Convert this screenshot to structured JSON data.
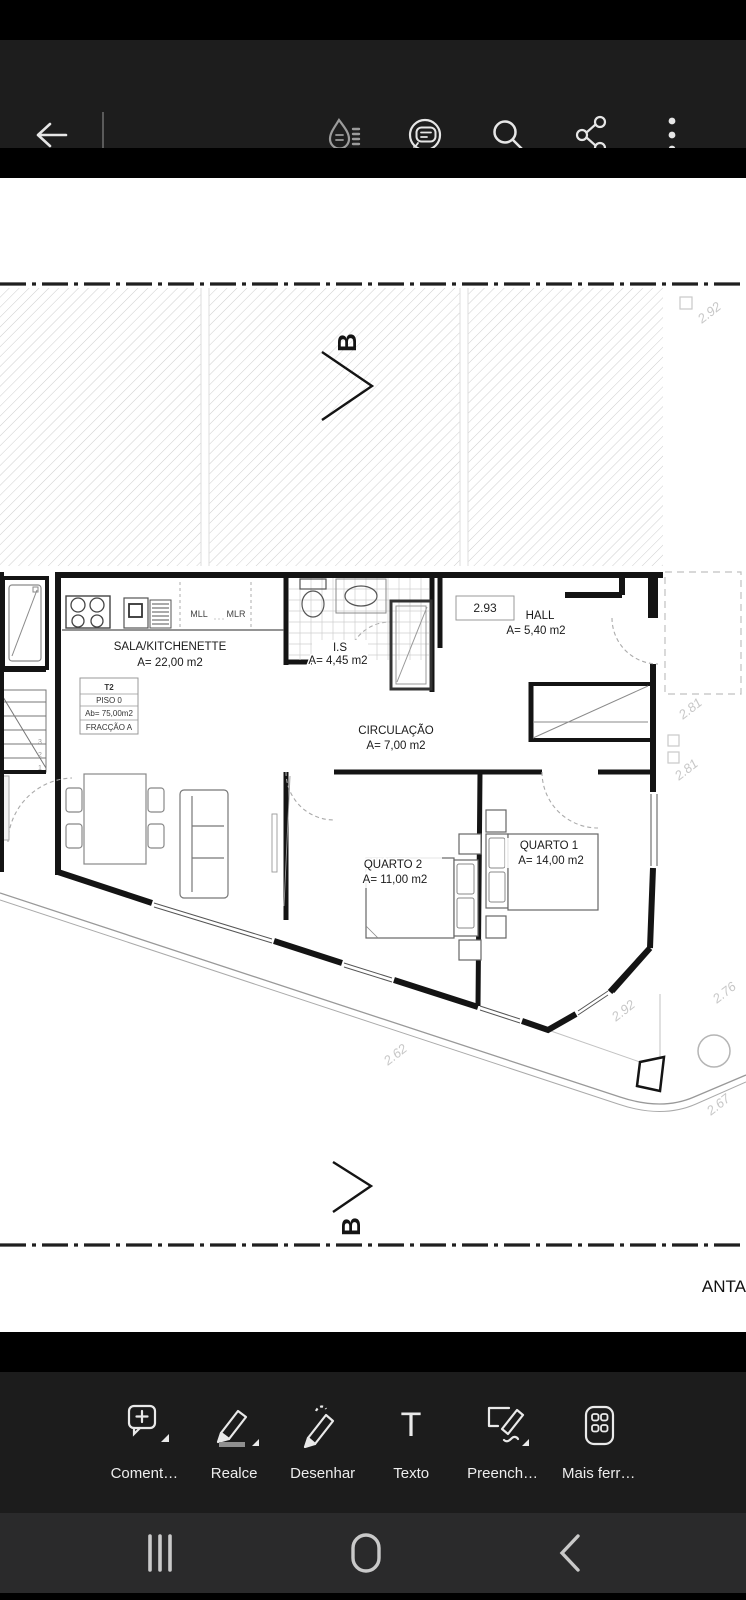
{
  "plan": {
    "rooms": [
      {
        "name": "SALA/KITCHENETTE",
        "area": "A= 22,00 m2"
      },
      {
        "name": "I.S",
        "area": "A= 4,45 m2"
      },
      {
        "name": "HALL",
        "area": "A= 5,40 m2"
      },
      {
        "name": "CIRCULAÇÃO",
        "area": "A= 7,00 m2"
      },
      {
        "name": "QUARTO 1",
        "area": "A= 14,00 m2"
      },
      {
        "name": "QUARTO 2",
        "area": "A= 11,00 m2"
      }
    ],
    "unit_box": {
      "type": "T2",
      "floor": "PISO 0",
      "area": "Ab= 75,00m2",
      "fraction": "FRACÇÃO A"
    },
    "counter": {
      "left": "MLL",
      "right": "MLR"
    },
    "height_box": "2.93",
    "section_label": "B",
    "dims": {
      "top_right": "2.92",
      "right_1": "2.81",
      "right_2": "2.81",
      "right_3": "2.76",
      "bottom_left": "2.62",
      "bottom_mid": "2.92",
      "corner": "2.67"
    },
    "stairs": [
      "3",
      "2",
      "1"
    ],
    "partial_text": "ANTA"
  },
  "fab": {
    "icon": "ai-chat-sparkle"
  },
  "tools": [
    {
      "label": "Coment…",
      "icon": "add-comment"
    },
    {
      "label": "Realce",
      "icon": "highlighter"
    },
    {
      "label": "Desenhar",
      "icon": "draw-pencil"
    },
    {
      "label": "Texto",
      "icon": "text"
    },
    {
      "label": "Preench…",
      "icon": "fill-and-sign"
    },
    {
      "label": "Mais ferr…",
      "icon": "more-tools"
    }
  ],
  "app_bar": {
    "icons": [
      "back-arrow",
      "liquid-mode",
      "ai-assistant",
      "search",
      "share",
      "overflow-menu"
    ]
  },
  "nav_bar": {
    "icons": [
      "recents",
      "home",
      "back"
    ]
  },
  "colors": {
    "fab_start": "#c9286f",
    "fab_end": "#6d35ee",
    "app_bar_bg": "#1d1d1d",
    "toolbar_bg": "#1c1c1c",
    "nav_bg": "#2a2a2b"
  }
}
